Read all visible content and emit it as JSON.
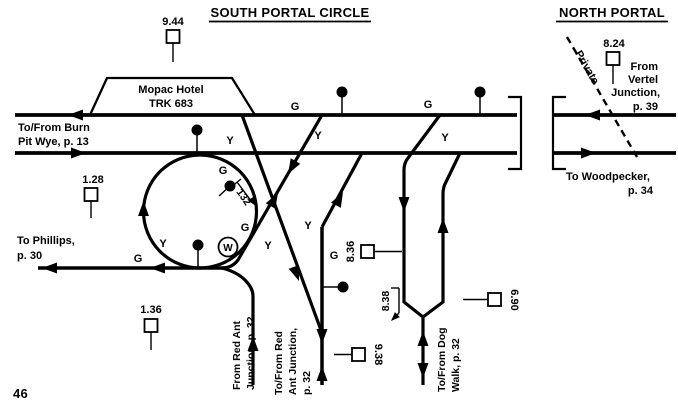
{
  "page": {
    "number": "46"
  },
  "south": {
    "title": "SOUTH PORTAL CIRCLE",
    "hotel": {
      "line1": "Mopac Hotel",
      "line2": "TRK 683"
    },
    "burn_pit": {
      "line1": "To/From Burn",
      "line2": "Pit Wye, p. 13"
    },
    "phillips": {
      "line1": "To Phillips,",
      "line2": "p. 30"
    },
    "from_red_ant": {
      "line1": "From Red Ant",
      "line2": "Junction, p. 32"
    },
    "tofrom_red_ant": {
      "line1": "To/From Red",
      "line2": "Ant Junction,",
      "line3": "p. 32"
    },
    "dog_walk": {
      "line1": "To/From Dog",
      "line2": "Walk, p. 32"
    },
    "track_pointer": "132",
    "whistle": "W",
    "aspect_g": "G",
    "aspect_y": "Y",
    "mileposts": {
      "mp944": "9.44",
      "mp128": "1.28",
      "mp136": "1.36",
      "mp836": "8.36",
      "mp838": "8.38",
      "mp938": "9.38",
      "mp690": "6.90"
    }
  },
  "north": {
    "title": "NORTH PORTAL",
    "milepost": "8.24",
    "private": "Private",
    "vertel": {
      "line1": "From",
      "line2": "Vertel",
      "line3": "Junction,",
      "line4": "p. 39"
    },
    "woodpecker": {
      "line1": "To Woodpecker,",
      "line2": "p. 34"
    }
  },
  "colors": {
    "ink": "#000000",
    "paper": "#ffffff"
  }
}
